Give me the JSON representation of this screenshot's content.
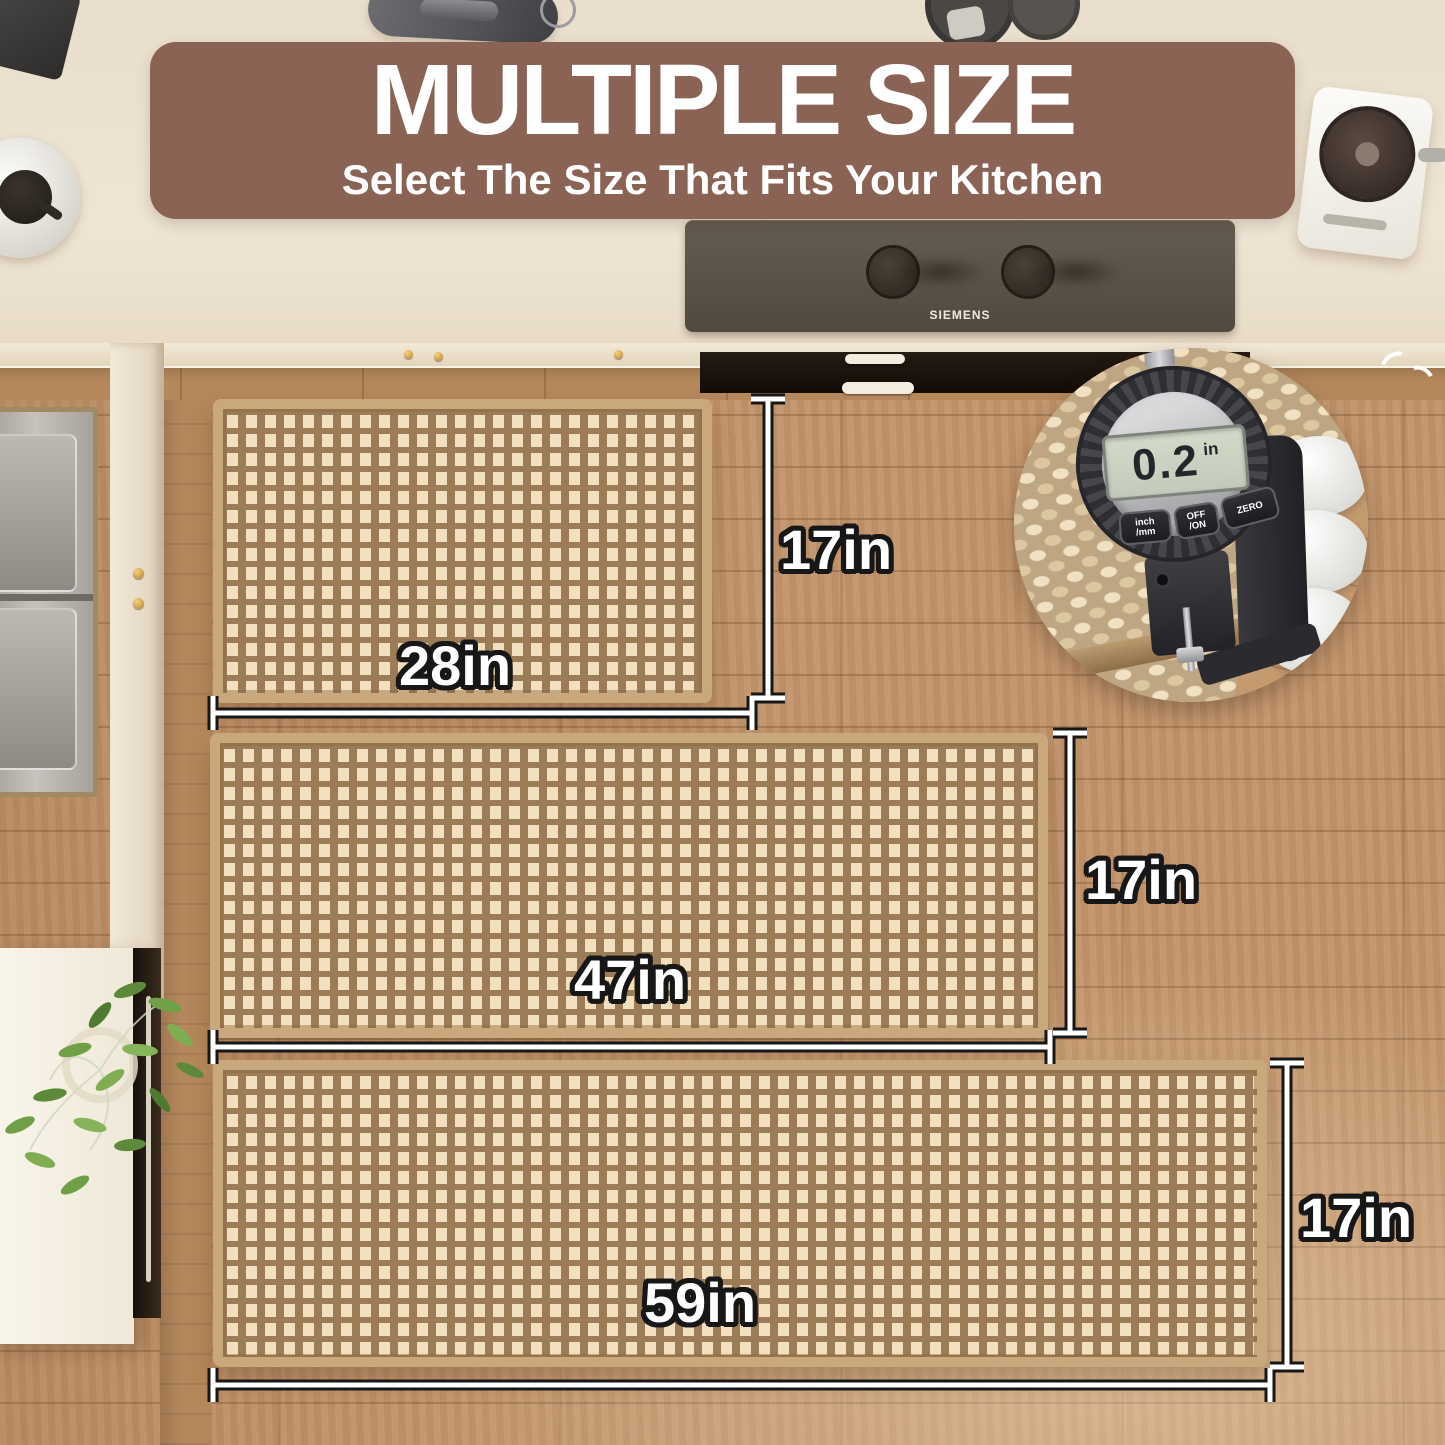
{
  "banner": {
    "title": "MULTIPLE SIZE",
    "subtitle": "Select The Size That Fits Your Kitchen"
  },
  "rugs": [
    {
      "name": "small",
      "width_label": "28in",
      "height_label": "17in"
    },
    {
      "name": "medium",
      "width_label": "47in",
      "height_label": "17in"
    },
    {
      "name": "large",
      "width_label": "59in",
      "height_label": "17in"
    }
  ],
  "gauge": {
    "value": "0.2",
    "unit": "in",
    "buttons": [
      "inch\n/mm",
      "OFF\n/ON",
      "ZERO"
    ]
  },
  "cooktop": {
    "brand": "SIEMENS"
  },
  "colors": {
    "banner_bg": "#8a6355",
    "floor_wood": "#c2946a",
    "rug_border": "#c9a87e",
    "weave_light": "#f2dfbd",
    "weave_dark": "#9c7c57",
    "dim_line_core": "#ffffff",
    "dim_line_casing": "#171717",
    "countertop": "#efe5d4"
  }
}
